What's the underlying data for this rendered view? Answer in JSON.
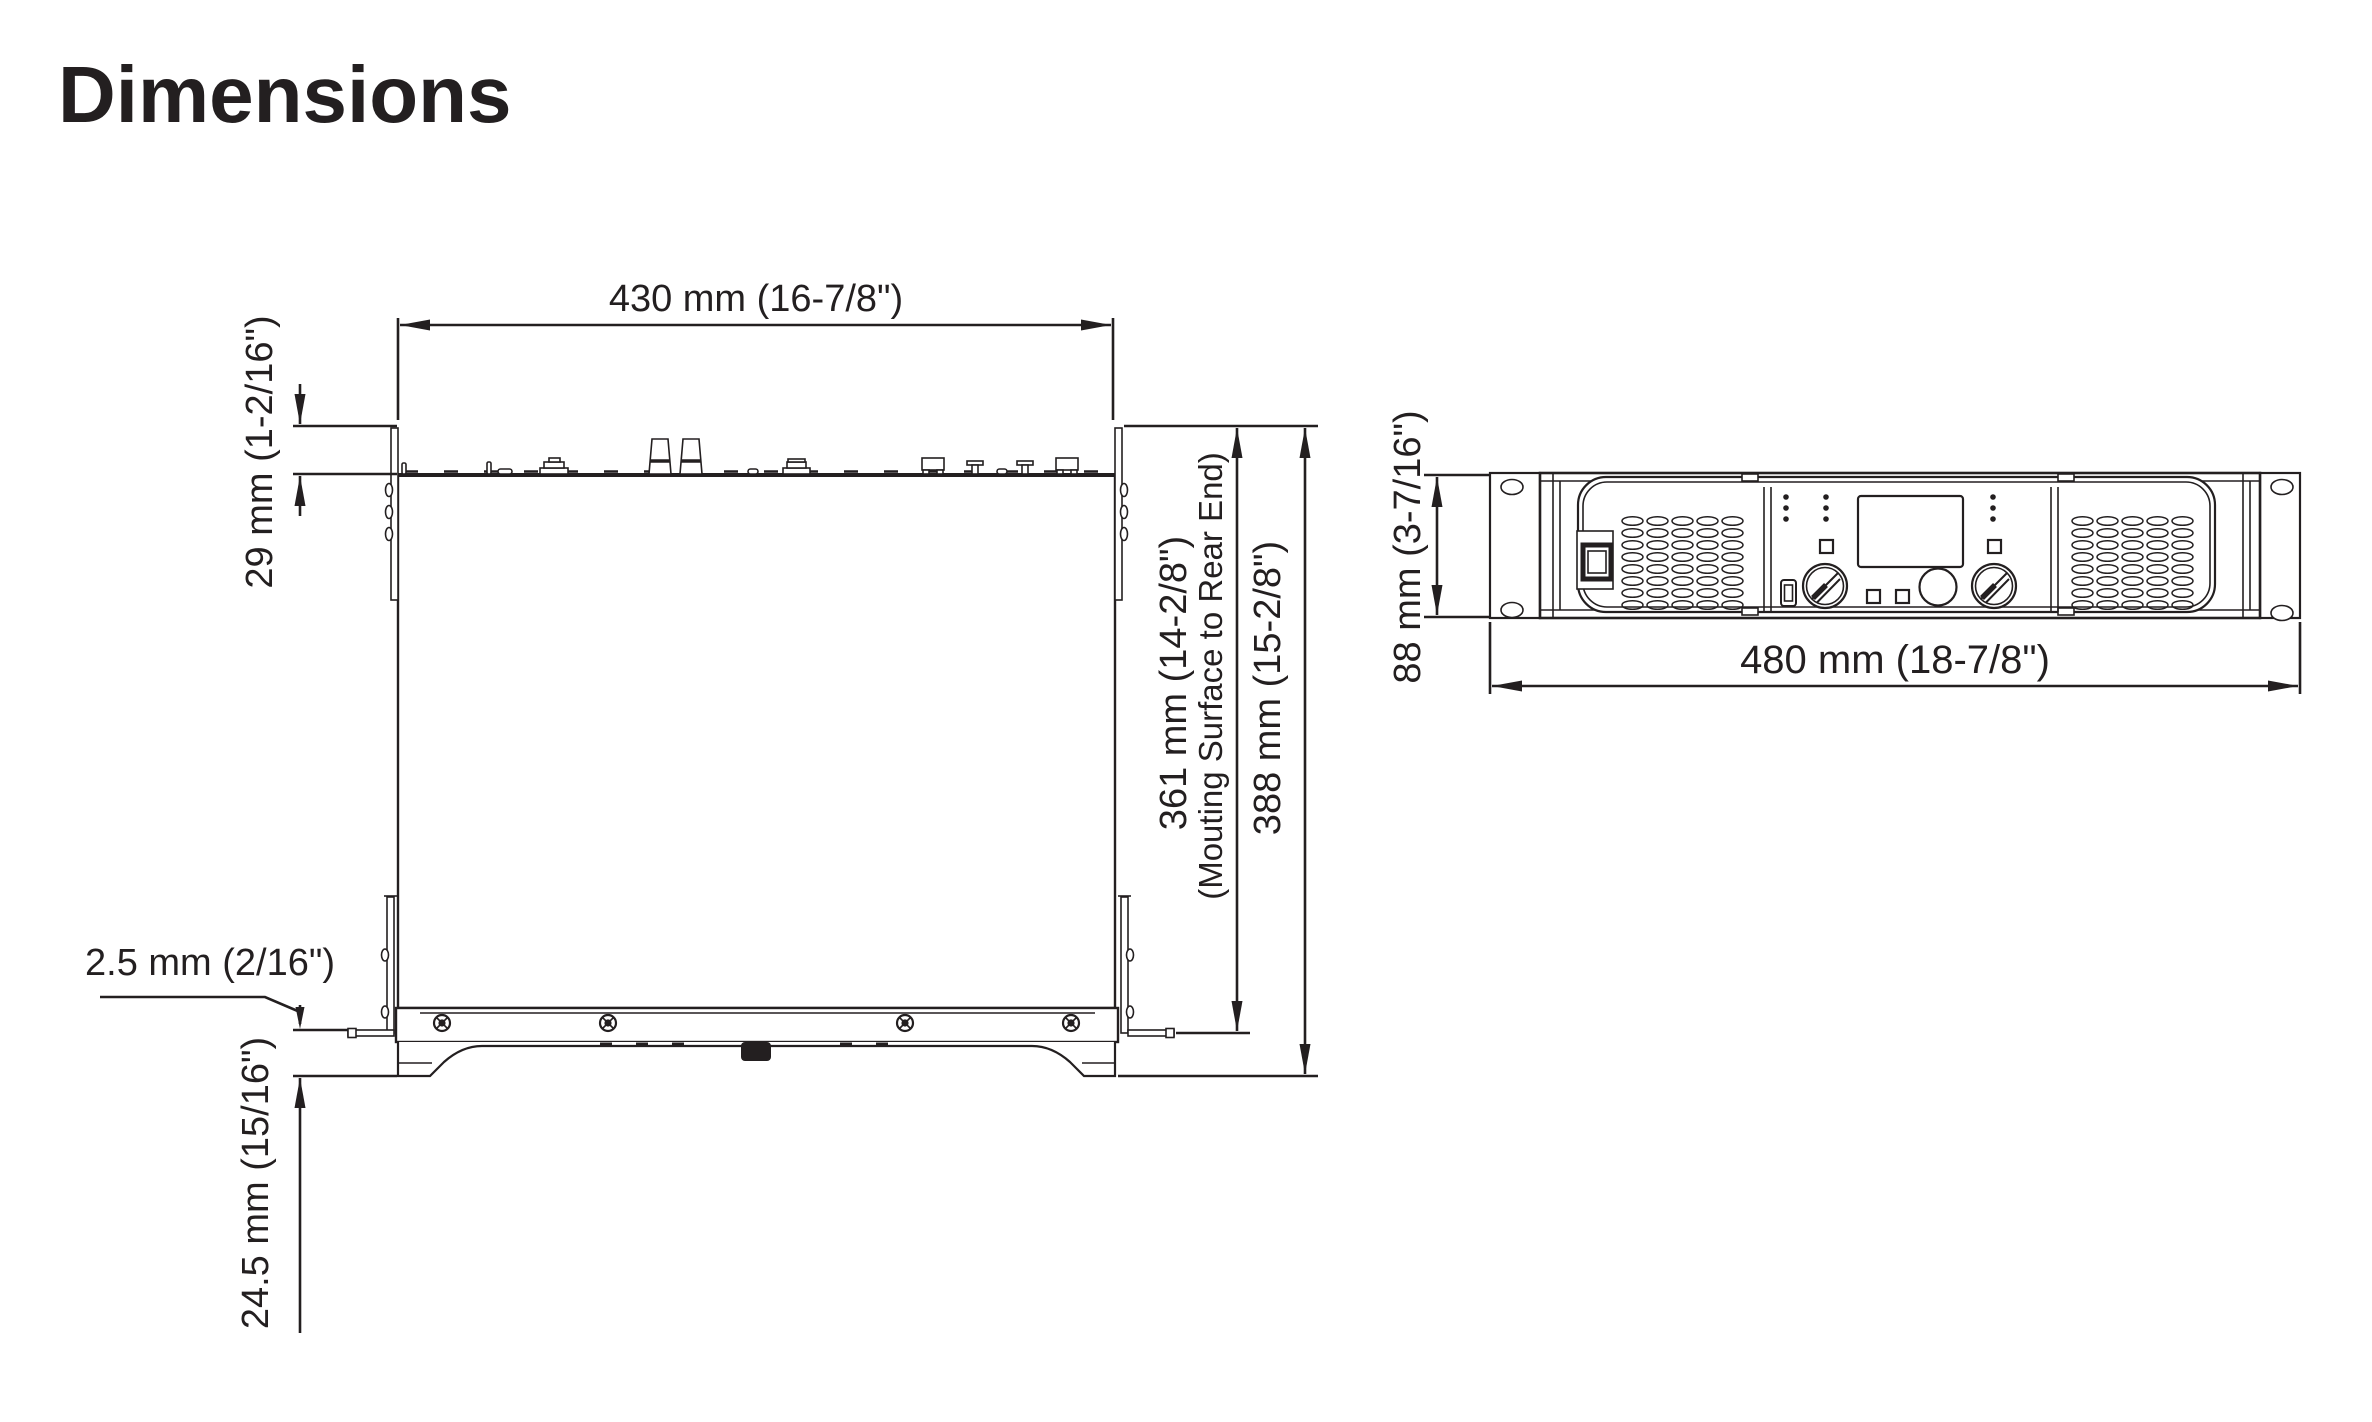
{
  "title": "Dimensions",
  "colors": {
    "ink": "#231f20",
    "background": "#ffffff"
  },
  "top_view": {
    "width_label": "430 mm (16-7/8\")",
    "rear_protrusion_label": "29 mm (1-2/16\")",
    "mounting_depth_label": "361 mm (14-2/8\")",
    "mounting_depth_note": "(Mouting Surface to Rear End)",
    "total_depth_label": "388 mm (15-2/8\")",
    "ear_offset_label": "2.5 mm (2/16\")",
    "front_depth_label": "24.5 mm (15/16\")"
  },
  "front_view": {
    "height_label": "88 mm (3-7/16\")",
    "width_label": "480 mm (18-7/8\")"
  }
}
